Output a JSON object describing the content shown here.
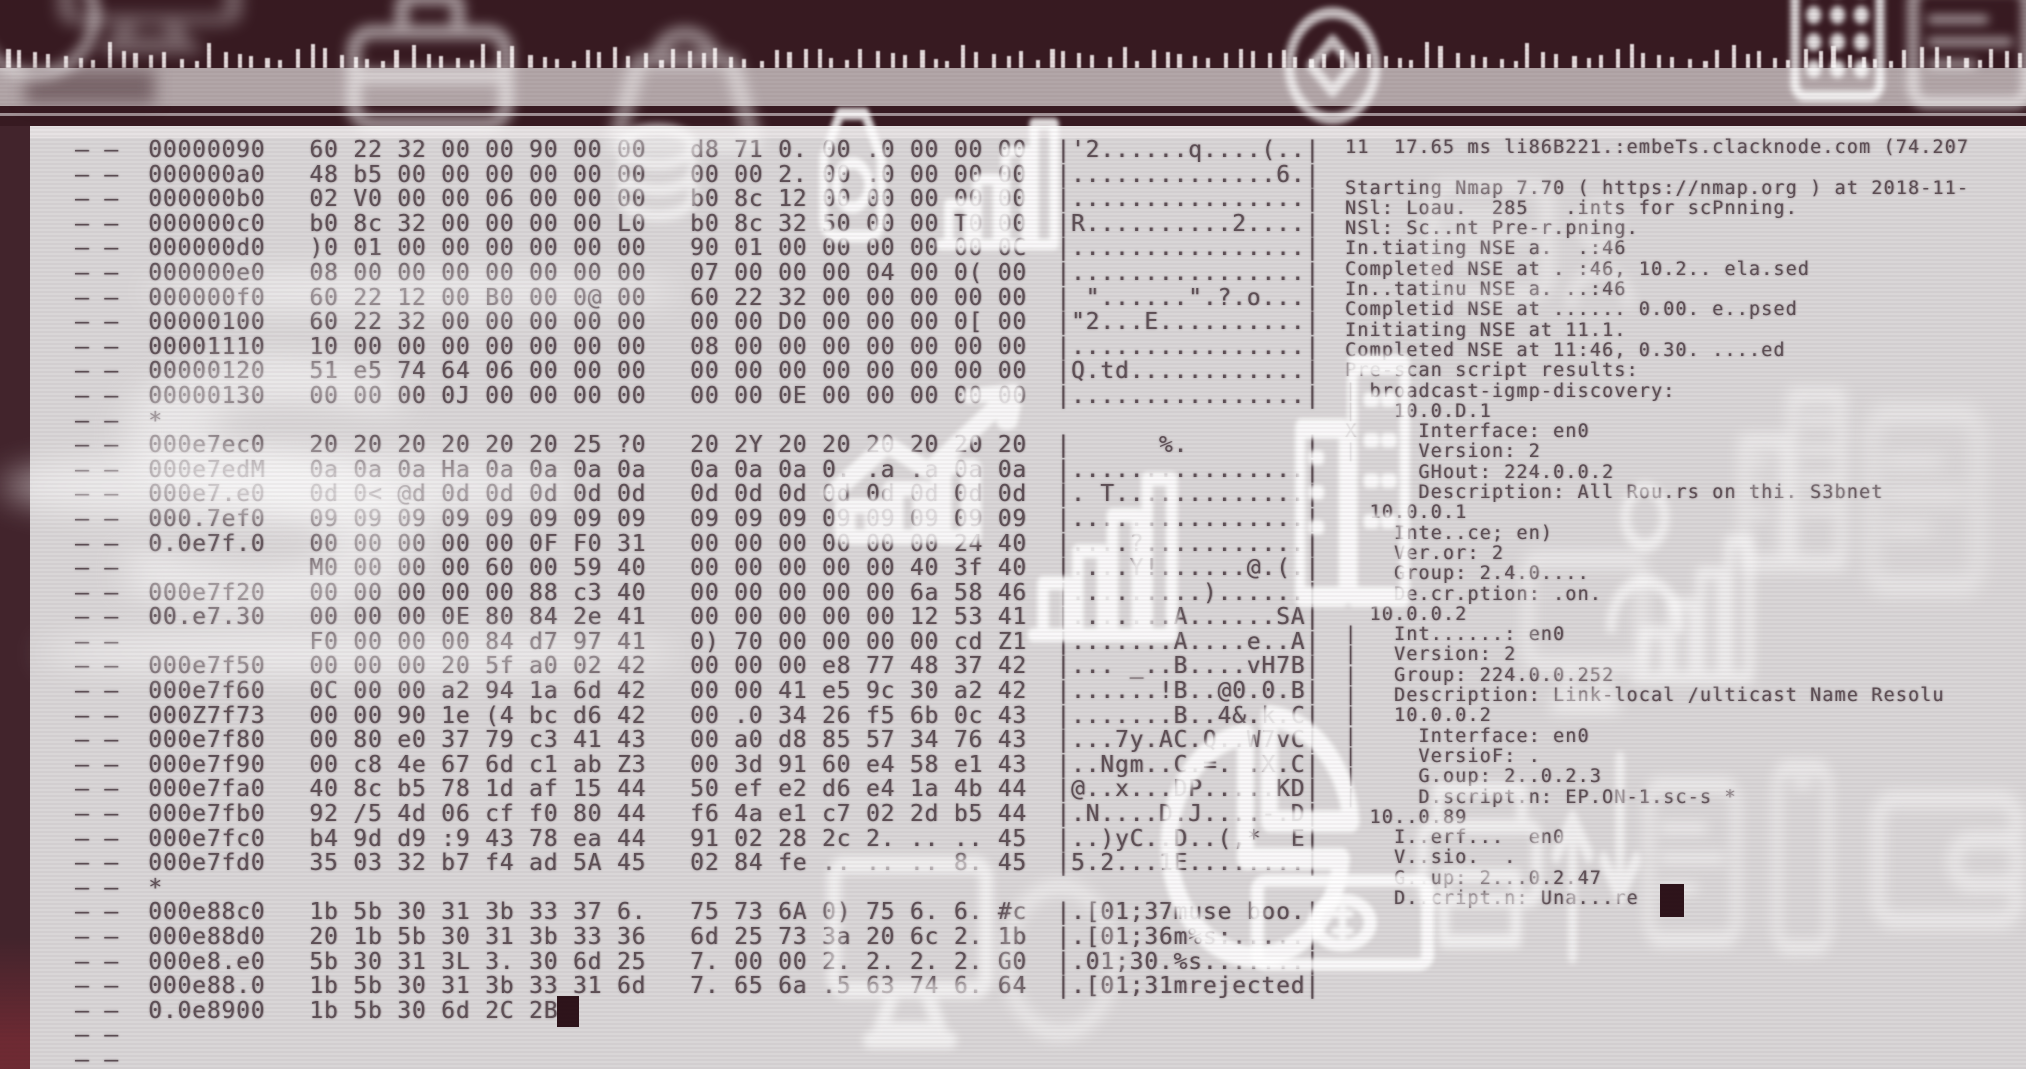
{
  "colors": {
    "band_dark": "#371a21",
    "band_mauve": "#b2a6a8",
    "panel": "#d9d6d7",
    "panel_top": "#e6e2e3",
    "side_strip": "#42242c",
    "side_strip_bottom": "#6e2a33",
    "ink": "#5d4f55",
    "cursor": "#2d131a",
    "tick": "#f2eaea",
    "watermark": "#ffffff"
  },
  "hexdump": {
    "row_prefix": "— —",
    "rows": [
      {
        "offset": "00000090",
        "hex1": "60 22 32 00 00 90 00 00",
        "hex2": "d8 71 0. 00 .0 00 00 00",
        "ascii": "|'2......q....(..|"
      },
      {
        "offset": "000000a0",
        "hex1": "48 b5 00 00 00 00 00 00",
        "hex2": "00 00 2. 00 .0 00 00 00",
        "ascii": "|..............6.|"
      },
      {
        "offset": "000000b0",
        "hex1": "02 V0 00 00 06 00 00 00",
        "hex2": "b0 8c 12 00 00 00 00 00",
        "ascii": "|................|"
      },
      {
        "offset": "000000c0",
        "hex1": "b0 8c 32 00 00 00 00 L0",
        "hex2": "b0 8c 32 50 00 00 T0 00",
        "ascii": "|R..........2....|"
      },
      {
        "offset": "000000d0",
        "hex1": ")0 01 00 00 00 00 00 00",
        "hex2": "90 01 00 00 00 00 00 0C",
        "ascii": "|................|"
      },
      {
        "offset": "000000e0",
        "hex1": "08 00 00 00 00 00 00 00",
        "hex2": "07 00 00 00 04 00 0( 00",
        "ascii": "|................|"
      },
      {
        "offset": "000000f0",
        "hex1": "60 22 12 00 B0 00 0@ 00",
        "hex2": "60 22 32 00 00 00 00 00",
        "ascii": "| \"......\".?.o...|"
      },
      {
        "offset": "00000100",
        "hex1": "60 22 32 00 00 00 00 00",
        "hex2": "00 00 D0 00 00 00 0[ 00",
        "ascii": "|\"2...E..........|"
      },
      {
        "offset": "00001110",
        "hex1": "10 00 00 00 00 00 00 00",
        "hex2": "08 00 00 00 00 00 00 00",
        "ascii": "|................|"
      },
      {
        "offset": "00000120",
        "hex1": "51 e5 74 64 06 00 00 00",
        "hex2": "00 00 00 00 00 00 00 00",
        "ascii": "|Q.td............|"
      },
      {
        "offset": "00000130",
        "hex1": "00 00 00 0J 00 00 00 00",
        "hex2": "00 00 0E 00 00 00 00 00",
        "ascii": "|................|"
      },
      {
        "offset": "*"
      },
      {
        "offset": "000e7ec0",
        "hex1": "20 20 20 20 20 20 25 ?0",
        "hex2": "20 2Y 20 20 20 20 20 20",
        "ascii": "|      %.        |"
      },
      {
        "offset": "000e7edM",
        "hex1": "0a 0a 0a Ha 0a 0a 0a 0a",
        "hex2": "0a 0a 0a 0. .a .a 0a 0a",
        "ascii": "|................|"
      },
      {
        "offset": "000e7.e0",
        "hex1": "0d 0< @d 0d 0d 0d 0d 0d",
        "hex2": "0d 0d 0d 0d 0d 0d 0d 0d",
        "ascii": "|. T.............|"
      },
      {
        "offset": "000.7ef0",
        "hex1": "09 09 09 09 09 09 09 09",
        "hex2": "09 09 09 09 09 09 09 09",
        "ascii": "|................|"
      },
      {
        "offset": "0.0e7f.0",
        "hex1": "00 00 00 00 00 0F F0 31",
        "hex2": "00 00 00 00 00 00 24 40",
        "ascii": "|....?...........|"
      },
      {
        "offset": "",
        "hex1": "M0 00 00 00 60 00 59 40",
        "hex2": "00 00 00 00 00 40 3f 40",
        "ascii": "|....Y!......@.(.|"
      },
      {
        "offset": "000e7f20",
        "hex1": "00 00 00 00 00 88 c3 40",
        "hex2": "00 00 00 00 00 6a 58 46",
        "ascii": "|.........)......|"
      },
      {
        "offset": "00.e7.30",
        "hex1": "00 00 00 0E 80 84 2e 41",
        "hex2": "00 00 00 00 00 12 53 41",
        "ascii": "|.......A......SA|"
      },
      {
        "offset": "",
        "hex1": "F0 00 00 00 84 d7 97 41",
        "hex2": "0) 70 00 00 00 00 cd Z1",
        "ascii": "|.......A....e..A|"
      },
      {
        "offset": "000e7f50",
        "hex1": "00 00 00 20 5f a0 02 42",
        "hex2": "00 00 00 e8 77 48 37 42",
        "ascii": "|... _..B....vH7B|"
      },
      {
        "offset": "000e7f60",
        "hex1": "0C 00 00 a2 94 1a 6d 42",
        "hex2": "00 00 41 e5 9c 30 a2 42",
        "ascii": "|......!B..@0.0.B|"
      },
      {
        "offset": "000Z7f73",
        "hex1": "00 00 90 1e (4 bc d6 42",
        "hex2": "00 .0 34 26 f5 6b 0c 43",
        "ascii": "|.......B..4&.k.C|"
      },
      {
        "offset": "000e7f80",
        "hex1": "00 80 e0 37 79 c3 41 43",
        "hex2": "00 a0 d8 85 57 34 76 43",
        "ascii": "|...7y.AC.Q..W7vC|"
      },
      {
        "offset": "000e7f90",
        "hex1": "00 c8 4e 67 6d c1 ab Z3",
        "hex2": "00 3d 91 60 e4 58 e1 43",
        "ascii": "|..Ngm..C.=. .X.C|"
      },
      {
        "offset": "000e7fa0",
        "hex1": "40 8c b5 78 1d af 15 44",
        "hex2": "50 ef e2 d6 e4 1a 4b 44",
        "ascii": "|@..x...DP.....KD|"
      },
      {
        "offset": "000e7fb0",
        "hex1": "92 /5 4d 06 cf f0 80 44",
        "hex2": "f6 4a e1 c7 02 2d b5 44",
        "ascii": "|.N....D.J....-.D|"
      },
      {
        "offset": "000e7fc0",
        "hex1": "b4 9d d9 :9 43 78 ea 44",
        "hex2": "91 02 28 2c 2. .. .. 45",
        "ascii": "|..)yC..D..(,*  E|"
      },
      {
        "offset": "000e7fd0",
        "hex1": "35 03 32 b7 f4 ad 5A 45",
        "hex2": "02 84 fe .. .. .. 8. 45",
        "ascii": "|5.2...1E........|"
      },
      {
        "offset": "*"
      },
      {
        "offset": "000e88c0",
        "hex1": "1b 5b 30 31 3b 33 37 6.",
        "hex2": "75 73 6A 0) 75 6. 6. #c",
        "ascii": "|.[01;37muse boo.|"
      },
      {
        "offset": "000e88d0",
        "hex1": "20 1b 5b 30 31 3b 33 36",
        "hex2": "6d 25 73 3a 20 6c 2. 1b",
        "ascii": "|.[01;36m%s:.....|"
      },
      {
        "offset": "000e8.e0",
        "hex1": "5b 30 31 3L 3. 30 6d 25",
        "hex2": "7. 00 00 2. 2. 2. 2. G0",
        "ascii": "|.01;30.%s.......|"
      },
      {
        "offset": "000e88.0",
        "hex1": "1b 5b 30 31 3b 33 31 6d",
        "hex2": "7. 65 6a .5 63 74 6. 64",
        "ascii": "|.[01;31mrejected|"
      },
      {
        "offset": "0.0e8900",
        "hex1": "1b 5b 30 6d 2C 2B",
        "cursor": true
      },
      {
        "offset": ""
      },
      {
        "offset": ""
      }
    ]
  },
  "nmap": {
    "lines": [
      "11  17.65 ms li86B221.:embeTs.clacknode.com (74.207",
      "",
      "Starting Nmap 7.70 ( https://nmap.org ) at 2018-11-",
      "NSl: Loau.  285   .ints for scPnning.",
      "NSl: Sc..nt Pre-r.pning.",
      "In.tiating NSE a.  .:46",
      "Completed NSE at . :46, 10.2.. ela.sed",
      "In..tatinu NSE a. ..:46",
      "Completid NSE at ...... 0.00. e..psed",
      "Initiating NSE at 11.1.",
      "Completed NSE at 11:46, 0.30. ....ed",
      "Pre-scan script results:",
      "| broadcast-igmp-discovery:",
      "|   10.0.D.1",
      "X     Interface: en0",
      "|     Version: 2",
      "      GHout: 224.0.0.2",
      "      Description: All Rou.rs on thi. S3bnet",
      "  10.0.0.1",
      "    Inte..ce; en)",
      "    Ver.or: 2",
      "    Group: 2.4.0....",
      "    De.cr.ption: .on.",
      "  10.0.0.2",
      "|   Int......: en0",
      "|   Version: 2",
      "|   Group: 224.0.0.252",
      "|   Description: Link-local /ulticast Name Resolu",
      "|   10.0.0.2",
      "|     Interface: en0",
      "|     VersioF: .",
      "|     G.oup: 2..0.2.3",
      "|     D.script.n: EP.ON-1.sc-s *",
      "  10..0.89",
      "    I..erf...  en0",
      "    V..sio.  .",
      "    G..up: 2...0.2.47",
      "    D..cript.n: Una...re"
    ]
  },
  "watermarks": [
    {
      "type": "ring-icon",
      "x": -50,
      "y": -70,
      "w": 170,
      "h": 170,
      "o": 0.5,
      "b": 6
    },
    {
      "type": "monitor-icon",
      "x": 40,
      "y": -70,
      "w": 220,
      "h": 140,
      "o": 0.35,
      "b": 8
    },
    {
      "type": "briefcase-icon",
      "x": 330,
      "y": -40,
      "w": 200,
      "h": 200,
      "o": 0.55,
      "b": 6
    },
    {
      "type": "handbag-icon",
      "x": 580,
      "y": -20,
      "w": 210,
      "h": 200,
      "o": 0.5,
      "b": 7
    },
    {
      "type": "coin-stack-icon",
      "x": 595,
      "y": 105,
      "w": 125,
      "h": 160,
      "o": 0.6,
      "b": 4
    },
    {
      "type": "money-bag-icon",
      "x": 790,
      "y": 90,
      "w": 125,
      "h": 170,
      "o": 0.85,
      "b": 2
    },
    {
      "type": "bar-chart-icon",
      "x": 930,
      "y": 105,
      "w": 135,
      "h": 155,
      "o": 0.85,
      "b": 2
    },
    {
      "type": "coin-ring-icon",
      "x": 1265,
      "y": -25,
      "w": 135,
      "h": 165,
      "o": 0.7,
      "b": 3
    },
    {
      "type": "keypad-icon",
      "x": 1775,
      "y": -45,
      "w": 125,
      "h": 150,
      "o": 0.85,
      "b": 3
    },
    {
      "type": "card-icon",
      "x": 1895,
      "y": -35,
      "w": 150,
      "h": 160,
      "o": 0.6,
      "b": 5
    },
    {
      "type": "card-icon",
      "x": 1415,
      "y": 165,
      "w": 150,
      "h": 150,
      "o": 0.5,
      "b": 7
    },
    {
      "type": "person-icon",
      "x": 1545,
      "y": 185,
      "w": 110,
      "h": 135,
      "o": 0.5,
      "b": 6
    },
    {
      "type": "letter-s",
      "x": 90,
      "y": 320,
      "w": 560,
      "h": 360,
      "o": 0.45,
      "b": 12
    },
    {
      "type": "line-chart-icon",
      "x": 815,
      "y": 330,
      "w": 300,
      "h": 220,
      "o": 0.8,
      "b": 2
    },
    {
      "type": "bar-chart-icon",
      "x": 1020,
      "y": 455,
      "w": 165,
      "h": 200,
      "o": 0.85,
      "b": 2
    },
    {
      "type": "building-icon",
      "x": 1280,
      "y": 330,
      "w": 145,
      "h": 290,
      "o": 0.85,
      "b": 2
    },
    {
      "type": "building-icon",
      "x": 1725,
      "y": 370,
      "w": 135,
      "h": 210,
      "o": 0.5,
      "b": 7
    },
    {
      "type": "person-icon",
      "x": 1580,
      "y": 460,
      "w": 130,
      "h": 190,
      "o": 0.6,
      "b": 4
    },
    {
      "type": "bar-chart-icon",
      "x": 1625,
      "y": 520,
      "w": 135,
      "h": 175,
      "o": 0.55,
      "b": 5
    },
    {
      "type": "monitor-icon",
      "x": 1510,
      "y": 530,
      "w": 150,
      "h": 210,
      "o": 0.5,
      "b": 7
    },
    {
      "type": "card-icon",
      "x": 1855,
      "y": 380,
      "w": 140,
      "h": 240,
      "o": 0.45,
      "b": 9
    },
    {
      "type": "monitor-icon",
      "x": 810,
      "y": 830,
      "w": 200,
      "h": 250,
      "o": 0.6,
      "b": 4
    },
    {
      "type": "ring-icon",
      "x": 985,
      "y": 855,
      "w": 150,
      "h": 210,
      "o": 0.5,
      "b": 7
    },
    {
      "type": "pie-chart-icon",
      "x": 1135,
      "y": 685,
      "w": 240,
      "h": 310,
      "o": 0.85,
      "b": 2
    },
    {
      "type": "banknote-icon",
      "x": 1250,
      "y": 835,
      "w": 185,
      "h": 175,
      "o": 0.85,
      "b": 2
    },
    {
      "type": "printer-icon",
      "x": 1405,
      "y": 765,
      "w": 150,
      "h": 205,
      "o": 0.6,
      "b": 4
    },
    {
      "type": "arrows-icon",
      "x": 1535,
      "y": 735,
      "w": 125,
      "h": 245,
      "o": 0.6,
      "b": 3
    },
    {
      "type": "card-icon",
      "x": 1635,
      "y": 755,
      "w": 115,
      "h": 215,
      "o": 0.5,
      "b": 6
    },
    {
      "type": "smartphone-icon",
      "x": 1745,
      "y": 755,
      "w": 115,
      "h": 205,
      "o": 0.5,
      "b": 6
    },
    {
      "type": "wallet-icon",
      "x": 1865,
      "y": 745,
      "w": 165,
      "h": 225,
      "o": 0.5,
      "b": 7
    }
  ]
}
